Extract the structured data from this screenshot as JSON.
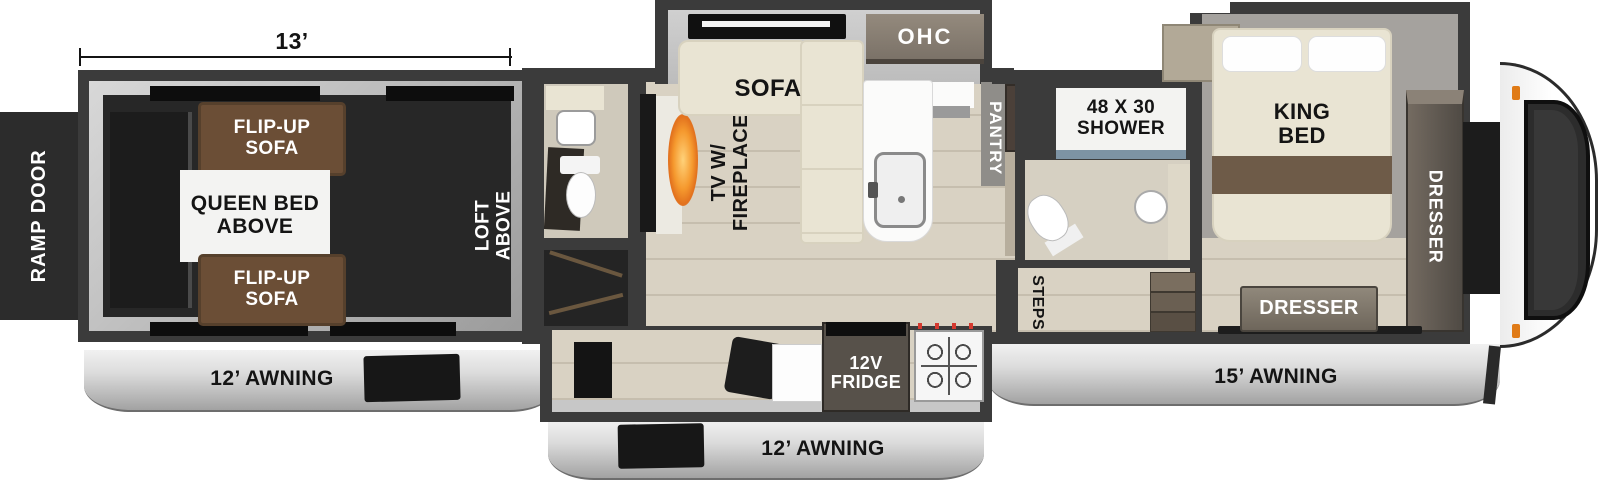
{
  "colors": {
    "wall": "#3b3b3b",
    "slide_silver": "#c7c7c7",
    "wood_floor": "#d9d2c3",
    "garage_floor": "#272727",
    "sofa_brown": "#6b4e36",
    "upholstery_cream": "#e9e4d3",
    "bed_stripe": "#6e5b48",
    "awning_silver": "#dcdcdc",
    "flame_orange": "#f5992e",
    "marker_orange": "#e07b17",
    "label_dark": "#141414",
    "label_light": "#ffffff"
  },
  "dimensions": {
    "garage_length": "13’"
  },
  "garage": {
    "ramp_door": "RAMP DOOR",
    "flip_up_sofa_top": "FLIP-UP\nSOFA",
    "queen_bed_above": "QUEEN BED\nABOVE",
    "flip_up_sofa_bottom": "FLIP-UP\nSOFA",
    "loft_above": "LOFT\nABOVE",
    "awning": "12’ AWNING"
  },
  "living": {
    "sofa": "SOFA",
    "overhead_cabinet": "OHC",
    "tv_fireplace": "TV W/\nFIREPLACE",
    "pantry": "PANTRY",
    "fridge": "12V\nFRIDGE",
    "awning": "12’ AWNING"
  },
  "bathroom": {
    "shower": "48 X 30\nSHOWER",
    "steps": "STEPS"
  },
  "bedroom": {
    "king_bed": "KING\nBED",
    "dresser_wardrobe": "DRESSER",
    "dresser_foot": "DRESSER",
    "awning": "15’ AWNING"
  }
}
